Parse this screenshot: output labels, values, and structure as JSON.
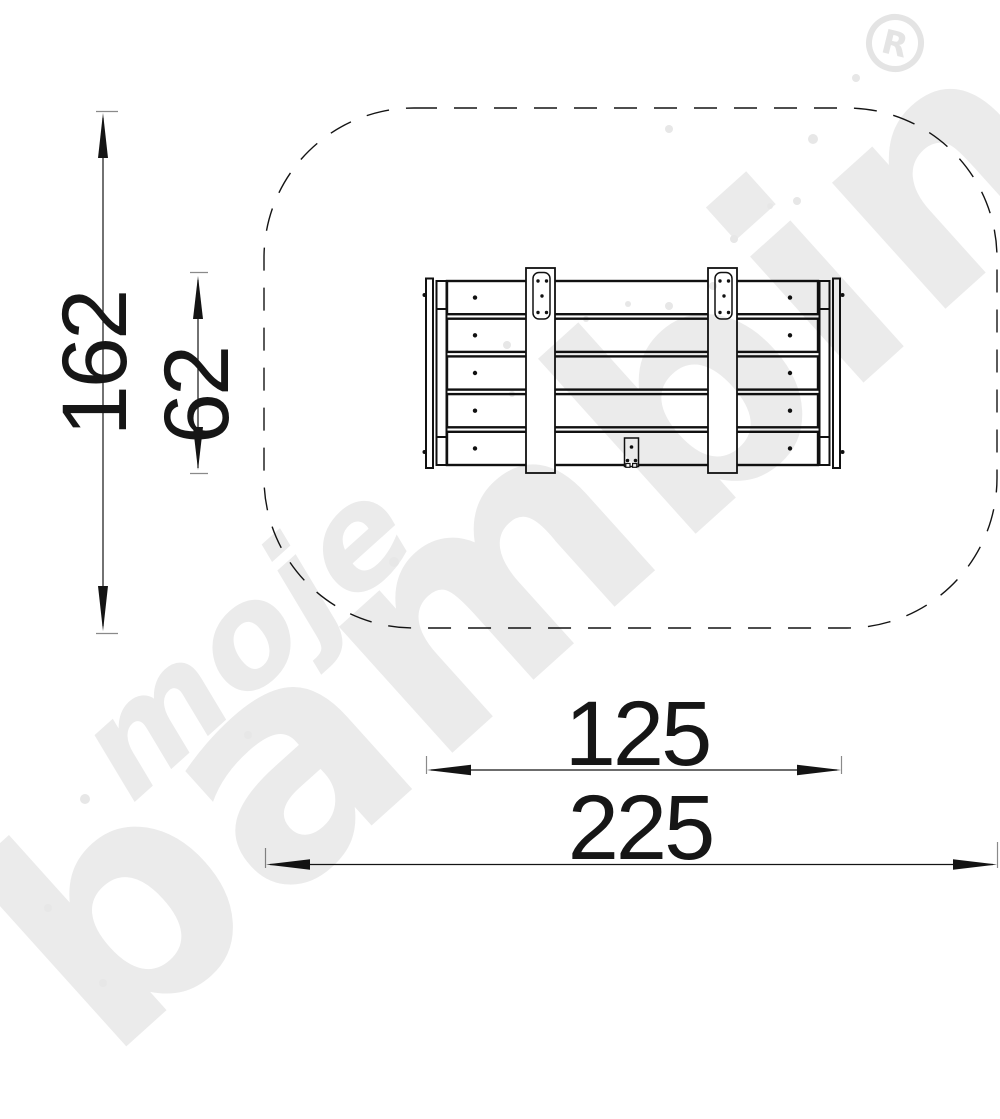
{
  "dimensions": {
    "safety_zone_depth": "162",
    "item_depth": "62",
    "item_width": "125",
    "safety_zone_width": "225"
  },
  "watermark": {
    "word1": "moje",
    "word2": "bambino",
    "registered_symbol": "R"
  },
  "colors": {
    "line": "#141414",
    "watermark_gray": "#ebebeb",
    "background": "#ffffff"
  }
}
